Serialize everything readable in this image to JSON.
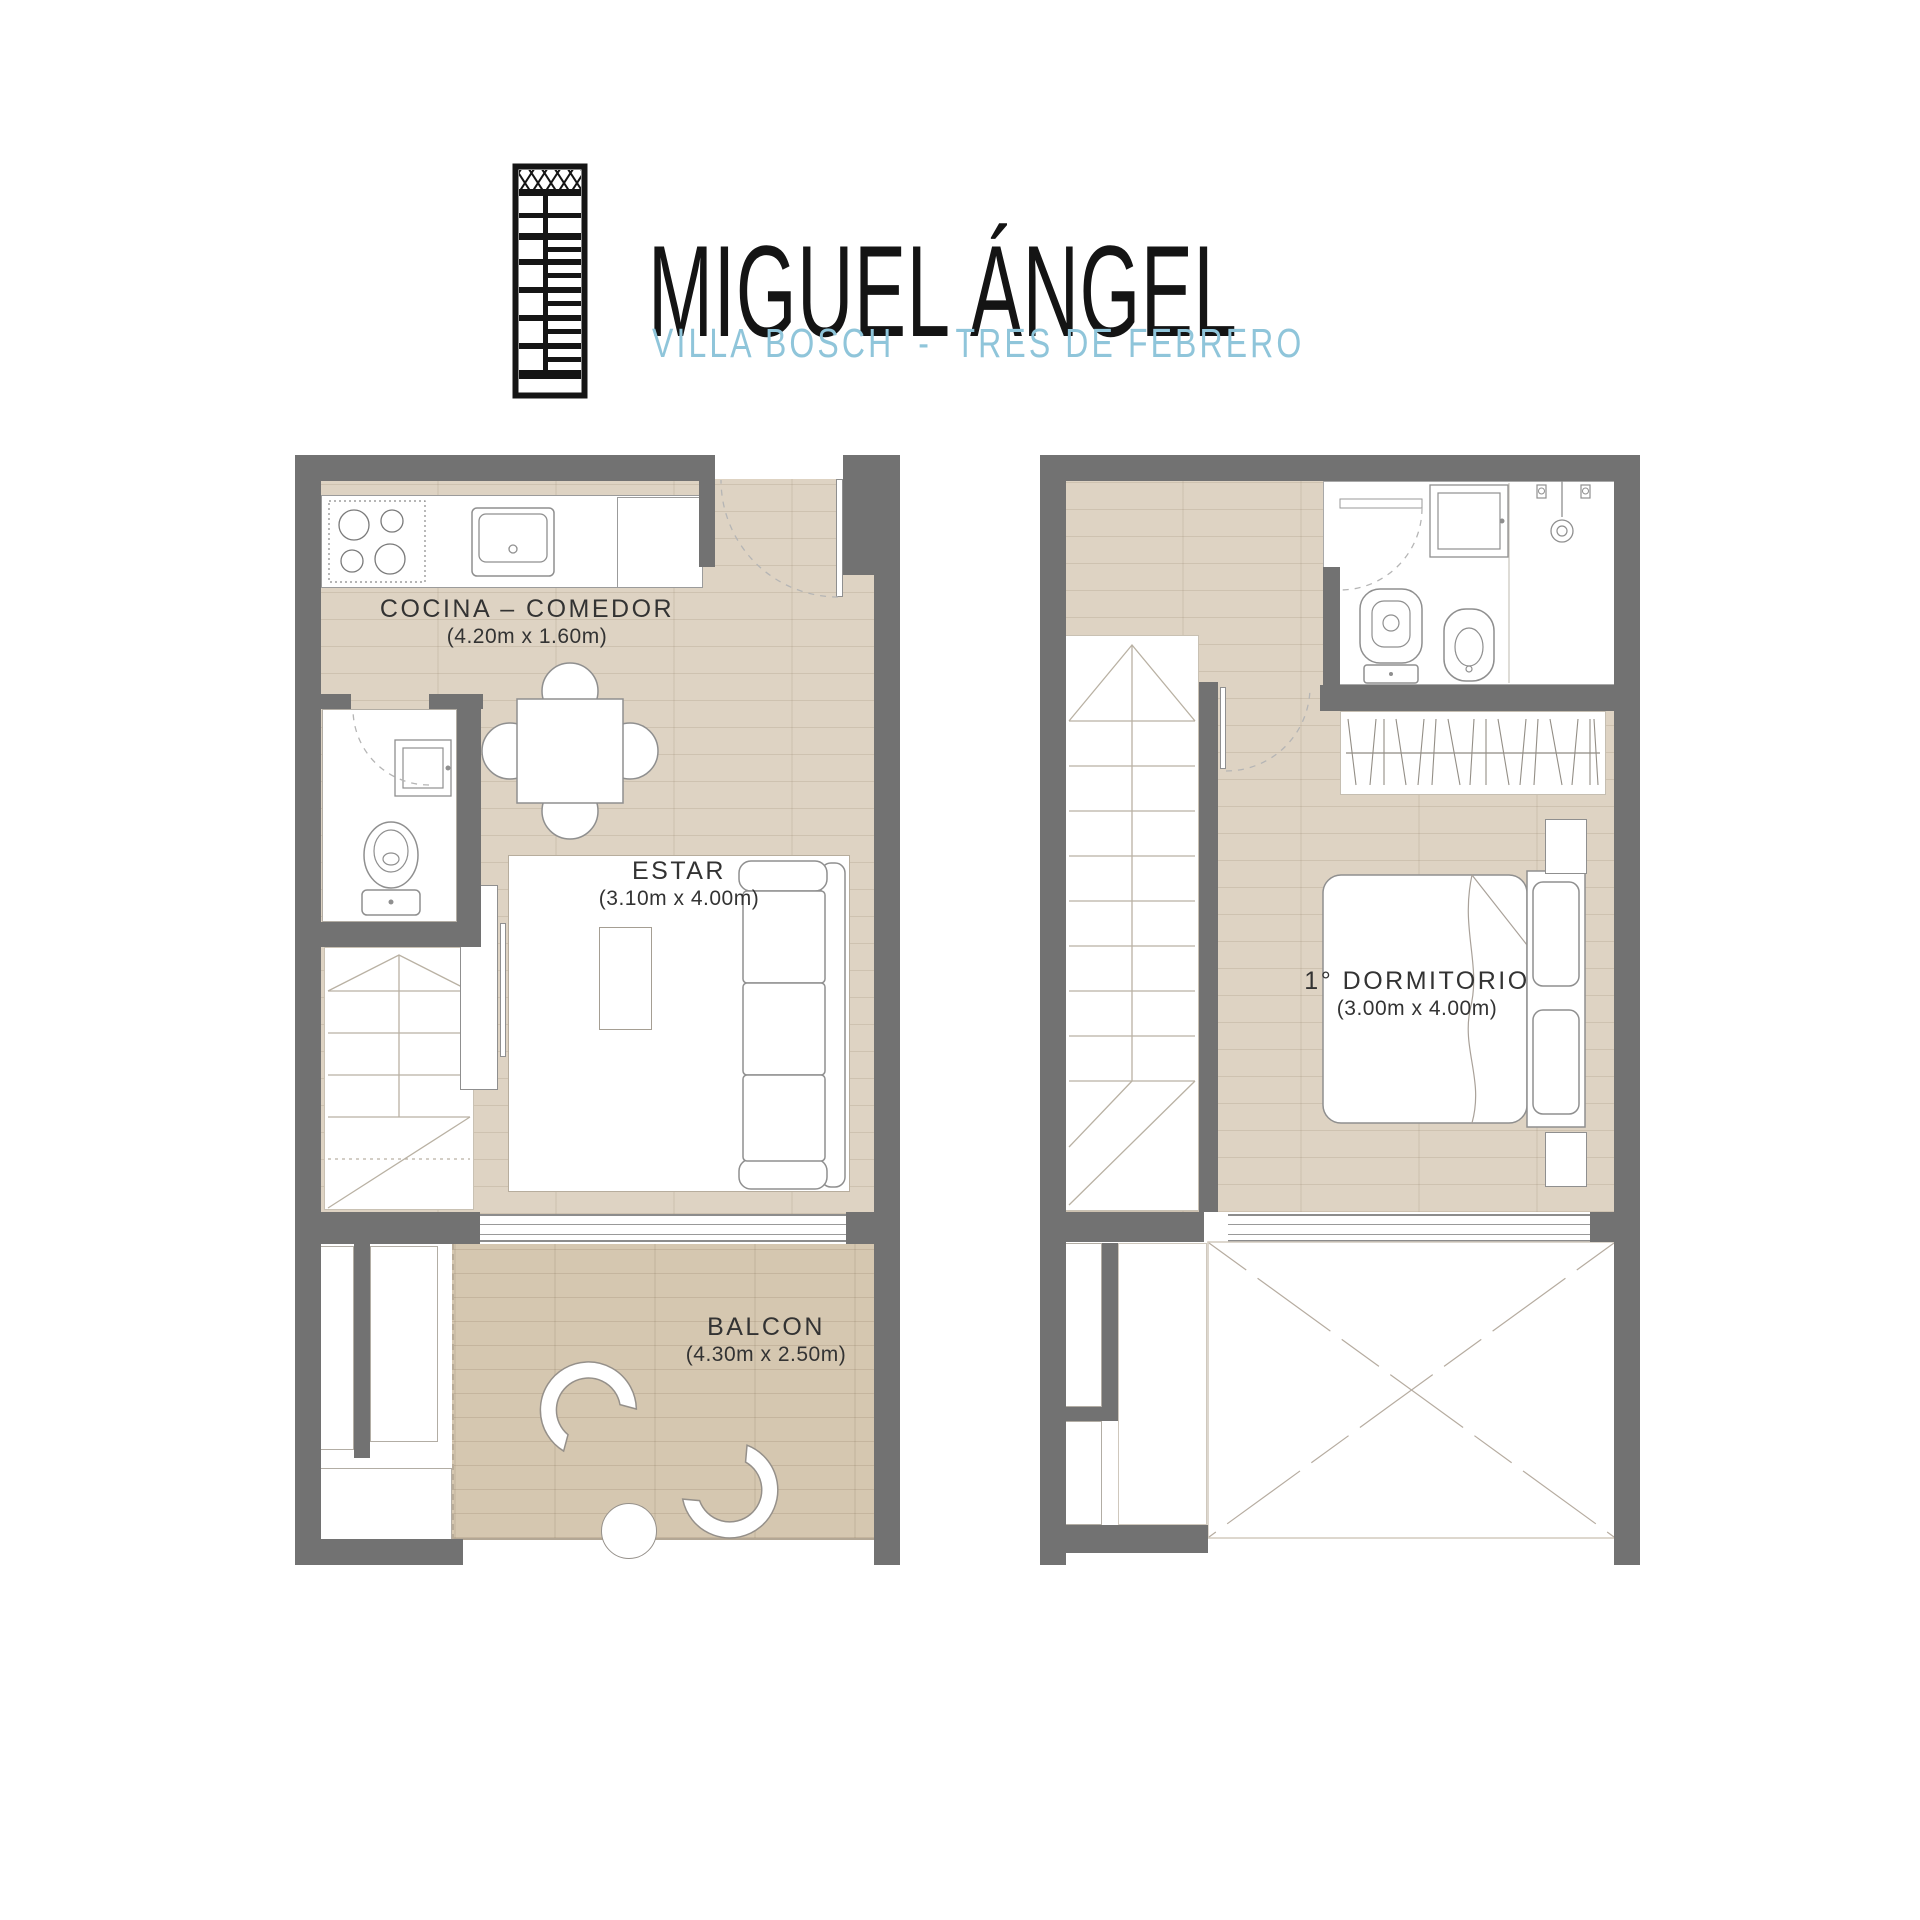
{
  "header": {
    "logo_icon": "building-elevation-icon",
    "title": "MIGUEL ÁNGEL",
    "subtitle": "VILLA BOSCH  -  TRES DE FEBRERO"
  },
  "plans": {
    "left": {
      "rooms": {
        "cocina": {
          "label": "COCINA – COMEDOR",
          "dims": "(4.20m x 1.60m)"
        },
        "estar": {
          "label": "ESTAR",
          "dims": "(3.10m x 4.00m)"
        },
        "balcon": {
          "label": "BALCON",
          "dims": "(4.30m x 2.50m)"
        }
      }
    },
    "right": {
      "rooms": {
        "dormitorio": {
          "label": "1° DORMITORIO",
          "dims": "(3.00m x 4.00m)"
        }
      }
    }
  },
  "colors": {
    "wall": "#727272",
    "wood": "#ded3c3",
    "deck": "#d5c7b0",
    "accent": "#8fc5da",
    "title": "#141414"
  }
}
